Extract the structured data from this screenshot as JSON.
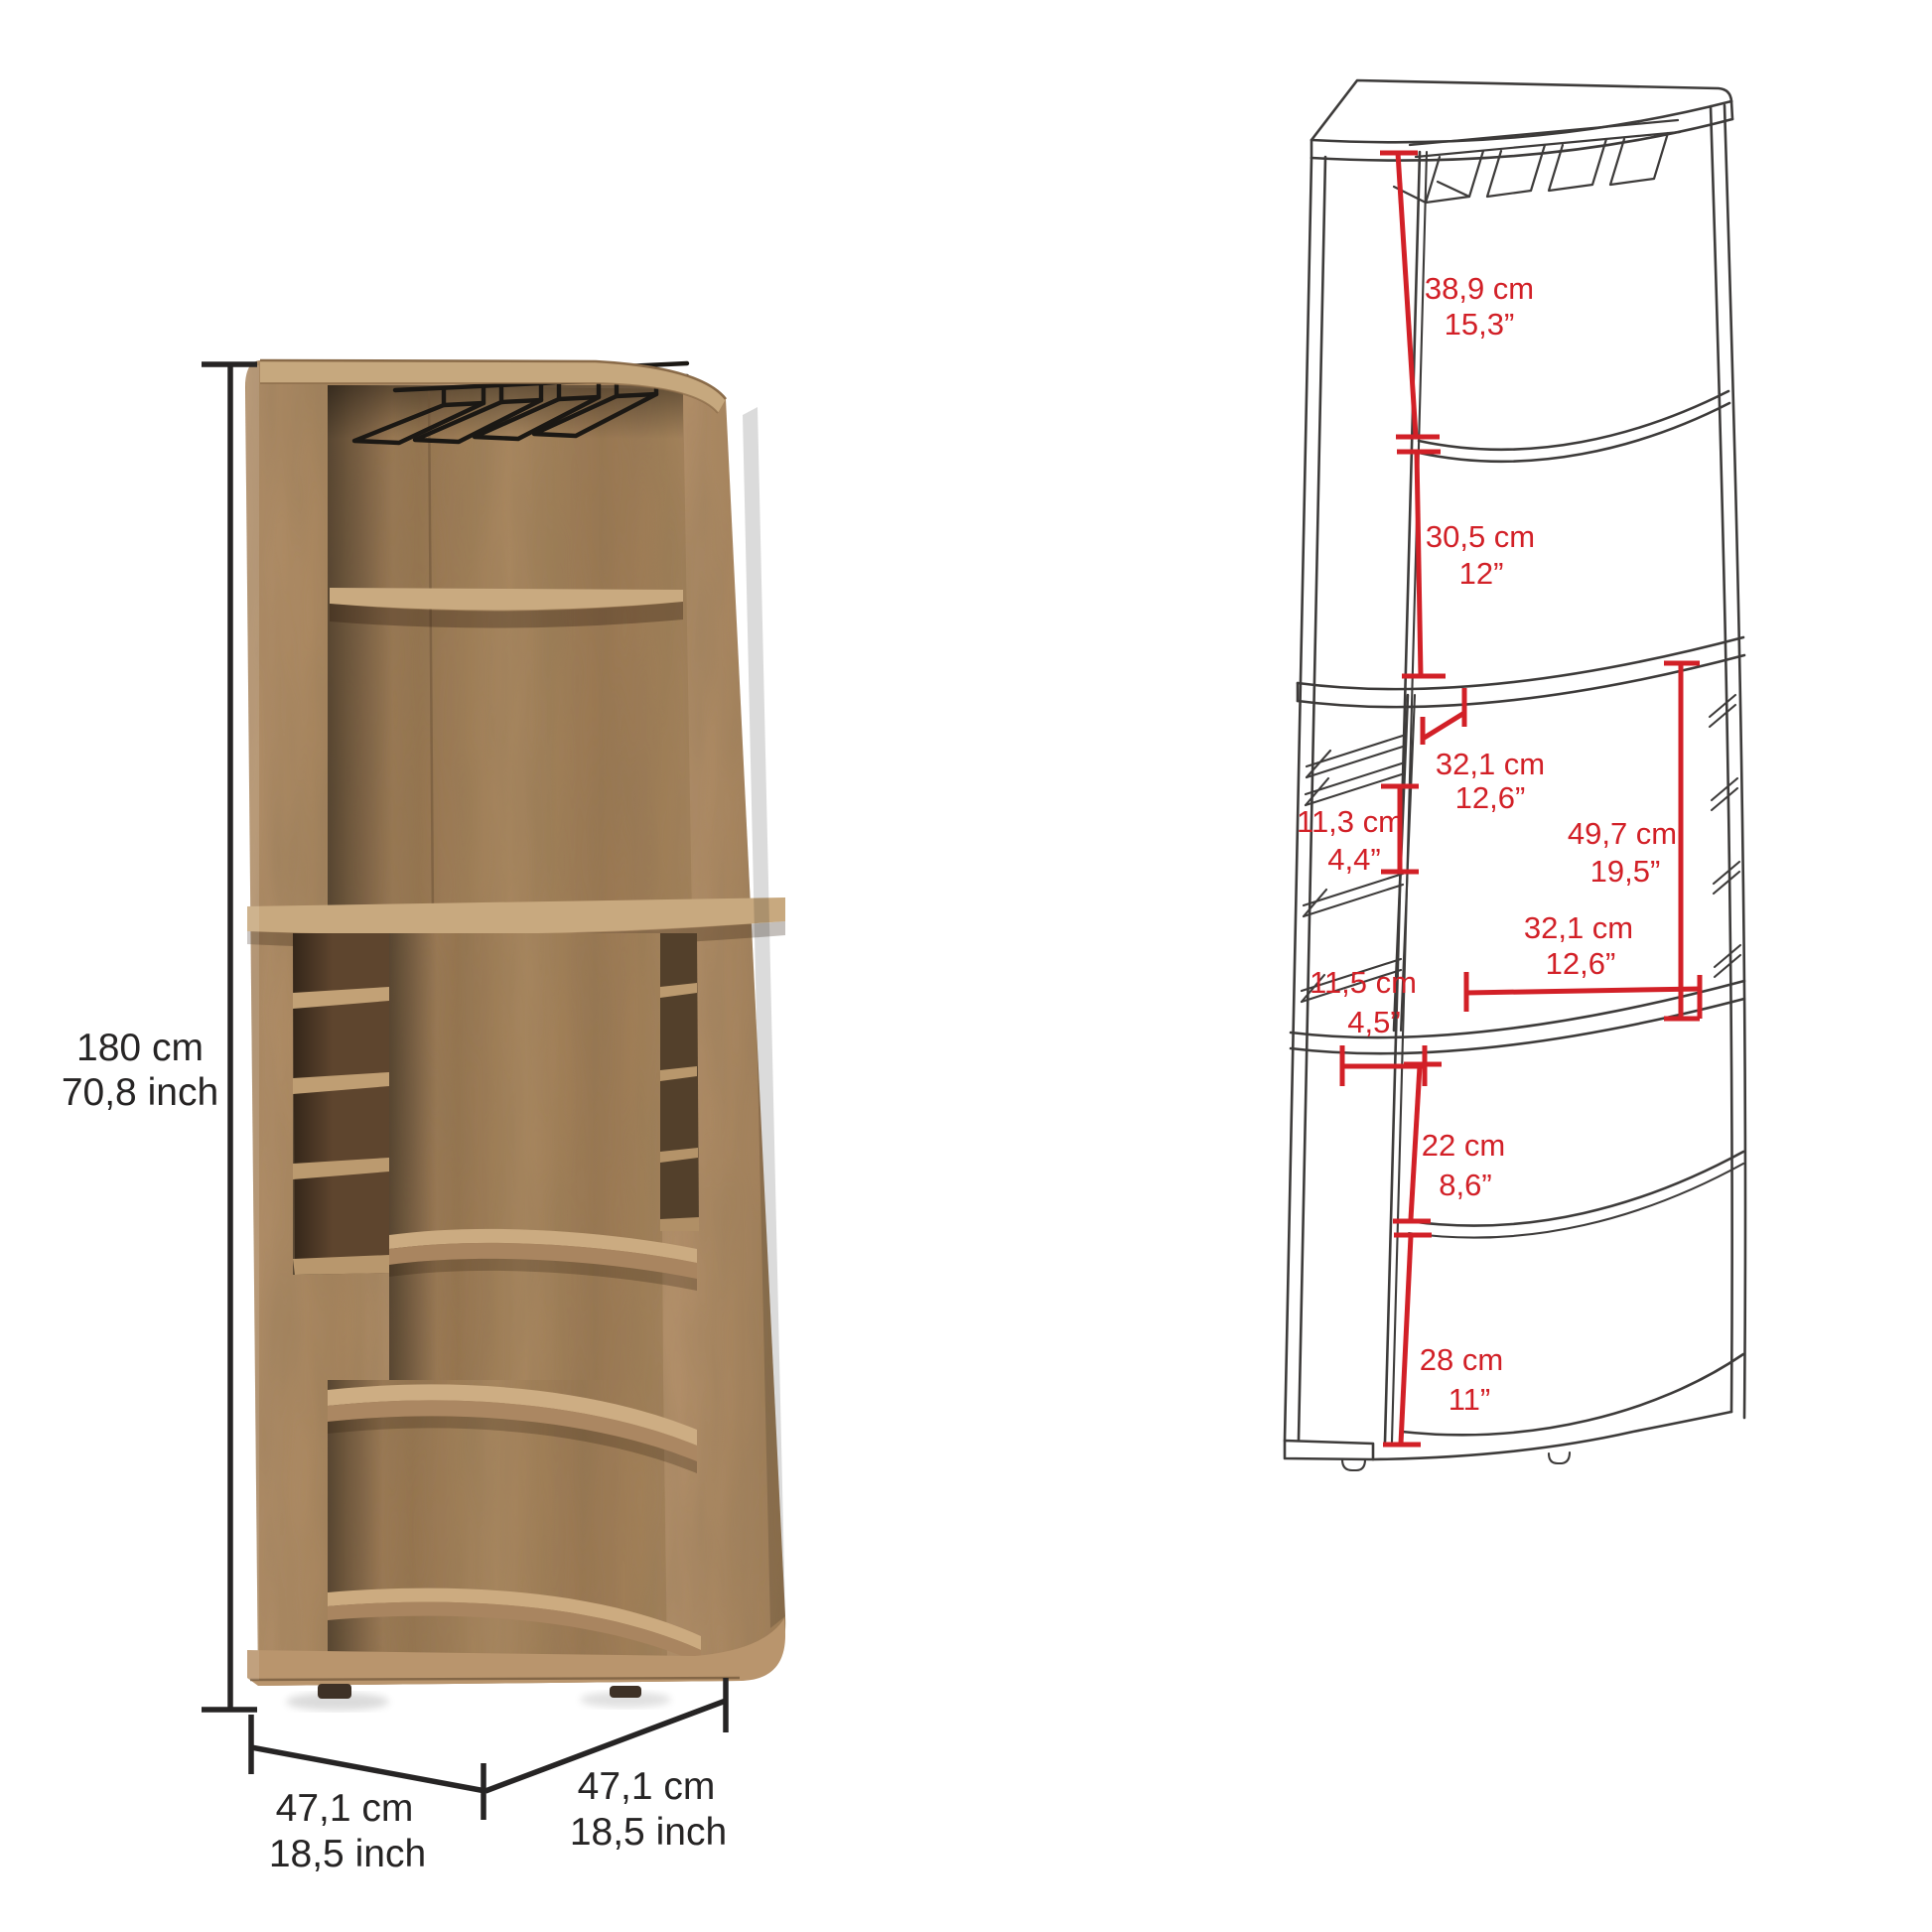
{
  "figure_left": {
    "height": {
      "cm": "180 cm",
      "inch": "70,8 inch"
    },
    "depth_left": {
      "cm": "47,1 cm",
      "inch": "18,5 inch"
    },
    "depth_right": {
      "cm": "47,1 cm",
      "inch": "18,5 inch"
    }
  },
  "figure_right": {
    "upper_opening_height": {
      "cm": "38,9 cm",
      "inch": "15,3”"
    },
    "upper_shelf_height": {
      "cm": "30,5 cm",
      "inch": "12”"
    },
    "middle_top_depth": {
      "cm": "32,1 cm",
      "inch": "12,6”"
    },
    "cubby_height": {
      "cm": "11,3 cm",
      "inch": "4,4”"
    },
    "middle_opening_height": {
      "cm": "49,7 cm",
      "inch": "19,5”"
    },
    "middle_opening_width": {
      "cm": "32,1 cm",
      "inch": "12,6”"
    },
    "cubby_depth": {
      "cm": "11,5 cm",
      "inch": "4,5”"
    },
    "lower_shelf_height": {
      "cm": "22 cm",
      "inch": "8,6”"
    },
    "lower_opening_height": {
      "cm": "28 cm",
      "inch": "11”"
    }
  },
  "colors": {
    "background": "#ffffff",
    "dimension_red": "#d22027",
    "dimension_black": "#262424",
    "drawing_line": "#3d3b3a",
    "wood_light": "#c9aa80",
    "wood_mid": "#ad8a62",
    "wood_dark": "#5e452e"
  }
}
